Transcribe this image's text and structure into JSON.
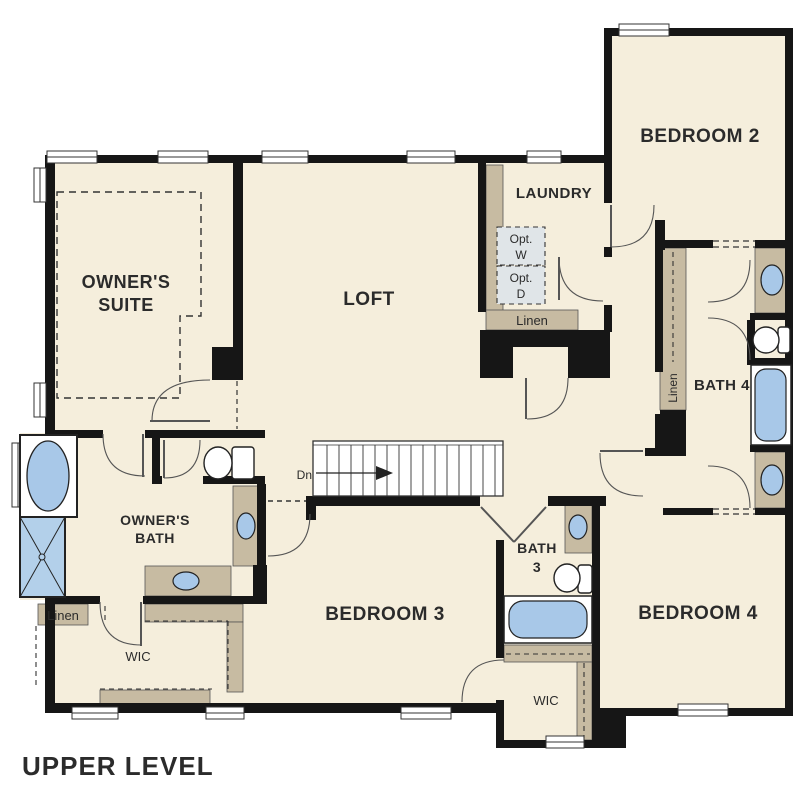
{
  "title": "UPPER LEVEL",
  "rooms": {
    "owners_suite_1": "OWNER'S",
    "owners_suite_2": "SUITE",
    "loft": "LOFT",
    "laundry": "LAUNDRY",
    "bedroom2": "BEDROOM 2",
    "bedroom3": "BEDROOM 3",
    "bedroom4": "BEDROOM 4",
    "owners_bath_1": "OWNER'S",
    "owners_bath_2": "BATH",
    "bath3_1": "BATH",
    "bath3_2": "3",
    "bath4": "BATH 4",
    "wic_owner": "WIC",
    "wic_hall": "WIC"
  },
  "closets": {
    "linen_hall": "Linen",
    "linen_owner": "Linen",
    "linen_bath4": "Linen"
  },
  "stairs": {
    "down": "Dn"
  },
  "appliances": {
    "washer_1": "Opt.",
    "washer_2": "W",
    "dryer_1": "Opt.",
    "dryer_2": "D"
  },
  "colors": {
    "floor": "#f5eedc",
    "wall": "#161616",
    "counter": "#c7bba2",
    "fixture_blue": "#a8c8e8",
    "shower_blue": "#b3d0ea",
    "optional_box": "#e0e5e8"
  }
}
